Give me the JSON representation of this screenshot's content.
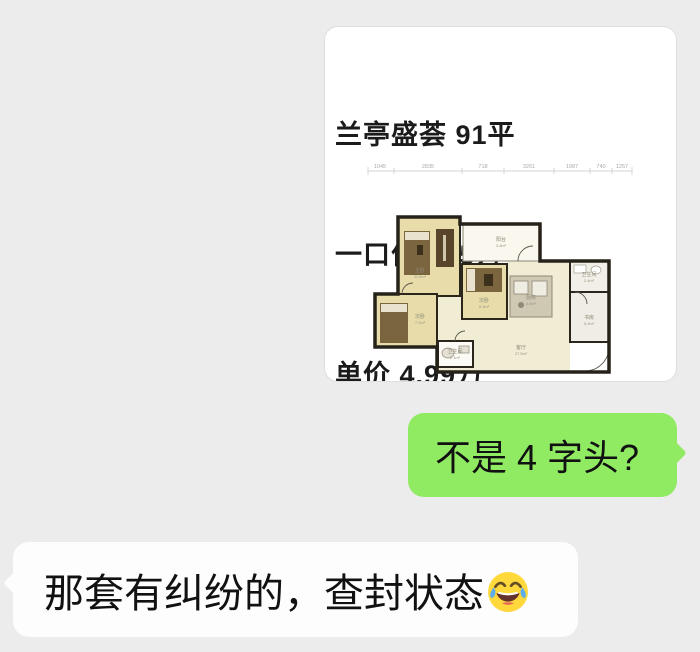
{
  "chat": {
    "background_color": "#ececec",
    "image_message": {
      "title_lines": [
        "兰亭盛荟 91平",
        "一口价 455万",
        "单价 4.99万"
      ],
      "floor_plan": {
        "dimension_labels": [
          "1045",
          "2835",
          "718",
          "3261",
          "1987",
          "740",
          "1257"
        ],
        "rooms": [
          {
            "name": "主卧",
            "area": "11.5m²"
          },
          {
            "name": "阳台",
            "area": "3.3m²"
          },
          {
            "name": "次卧",
            "area": "8.3m²"
          },
          {
            "name": "次卧",
            "area": "7.2m²"
          },
          {
            "name": "厨房",
            "area": "4.6m²"
          },
          {
            "name": "卫生间",
            "area": "2.4m²"
          },
          {
            "name": "书房",
            "area": "5.2m²"
          },
          {
            "name": "客厅",
            "area": "27.5m²"
          },
          {
            "name": "卫生间",
            "area": "2.1m²"
          }
        ]
      }
    },
    "outgoing_message": {
      "text": "不是 4 字头?",
      "bubble_color": "#90EB63"
    },
    "incoming_message": {
      "text": "那套有纠纷的，查封状态",
      "emoji": "face-with-tears-of-joy",
      "bubble_color": "#fdfdfd"
    }
  }
}
